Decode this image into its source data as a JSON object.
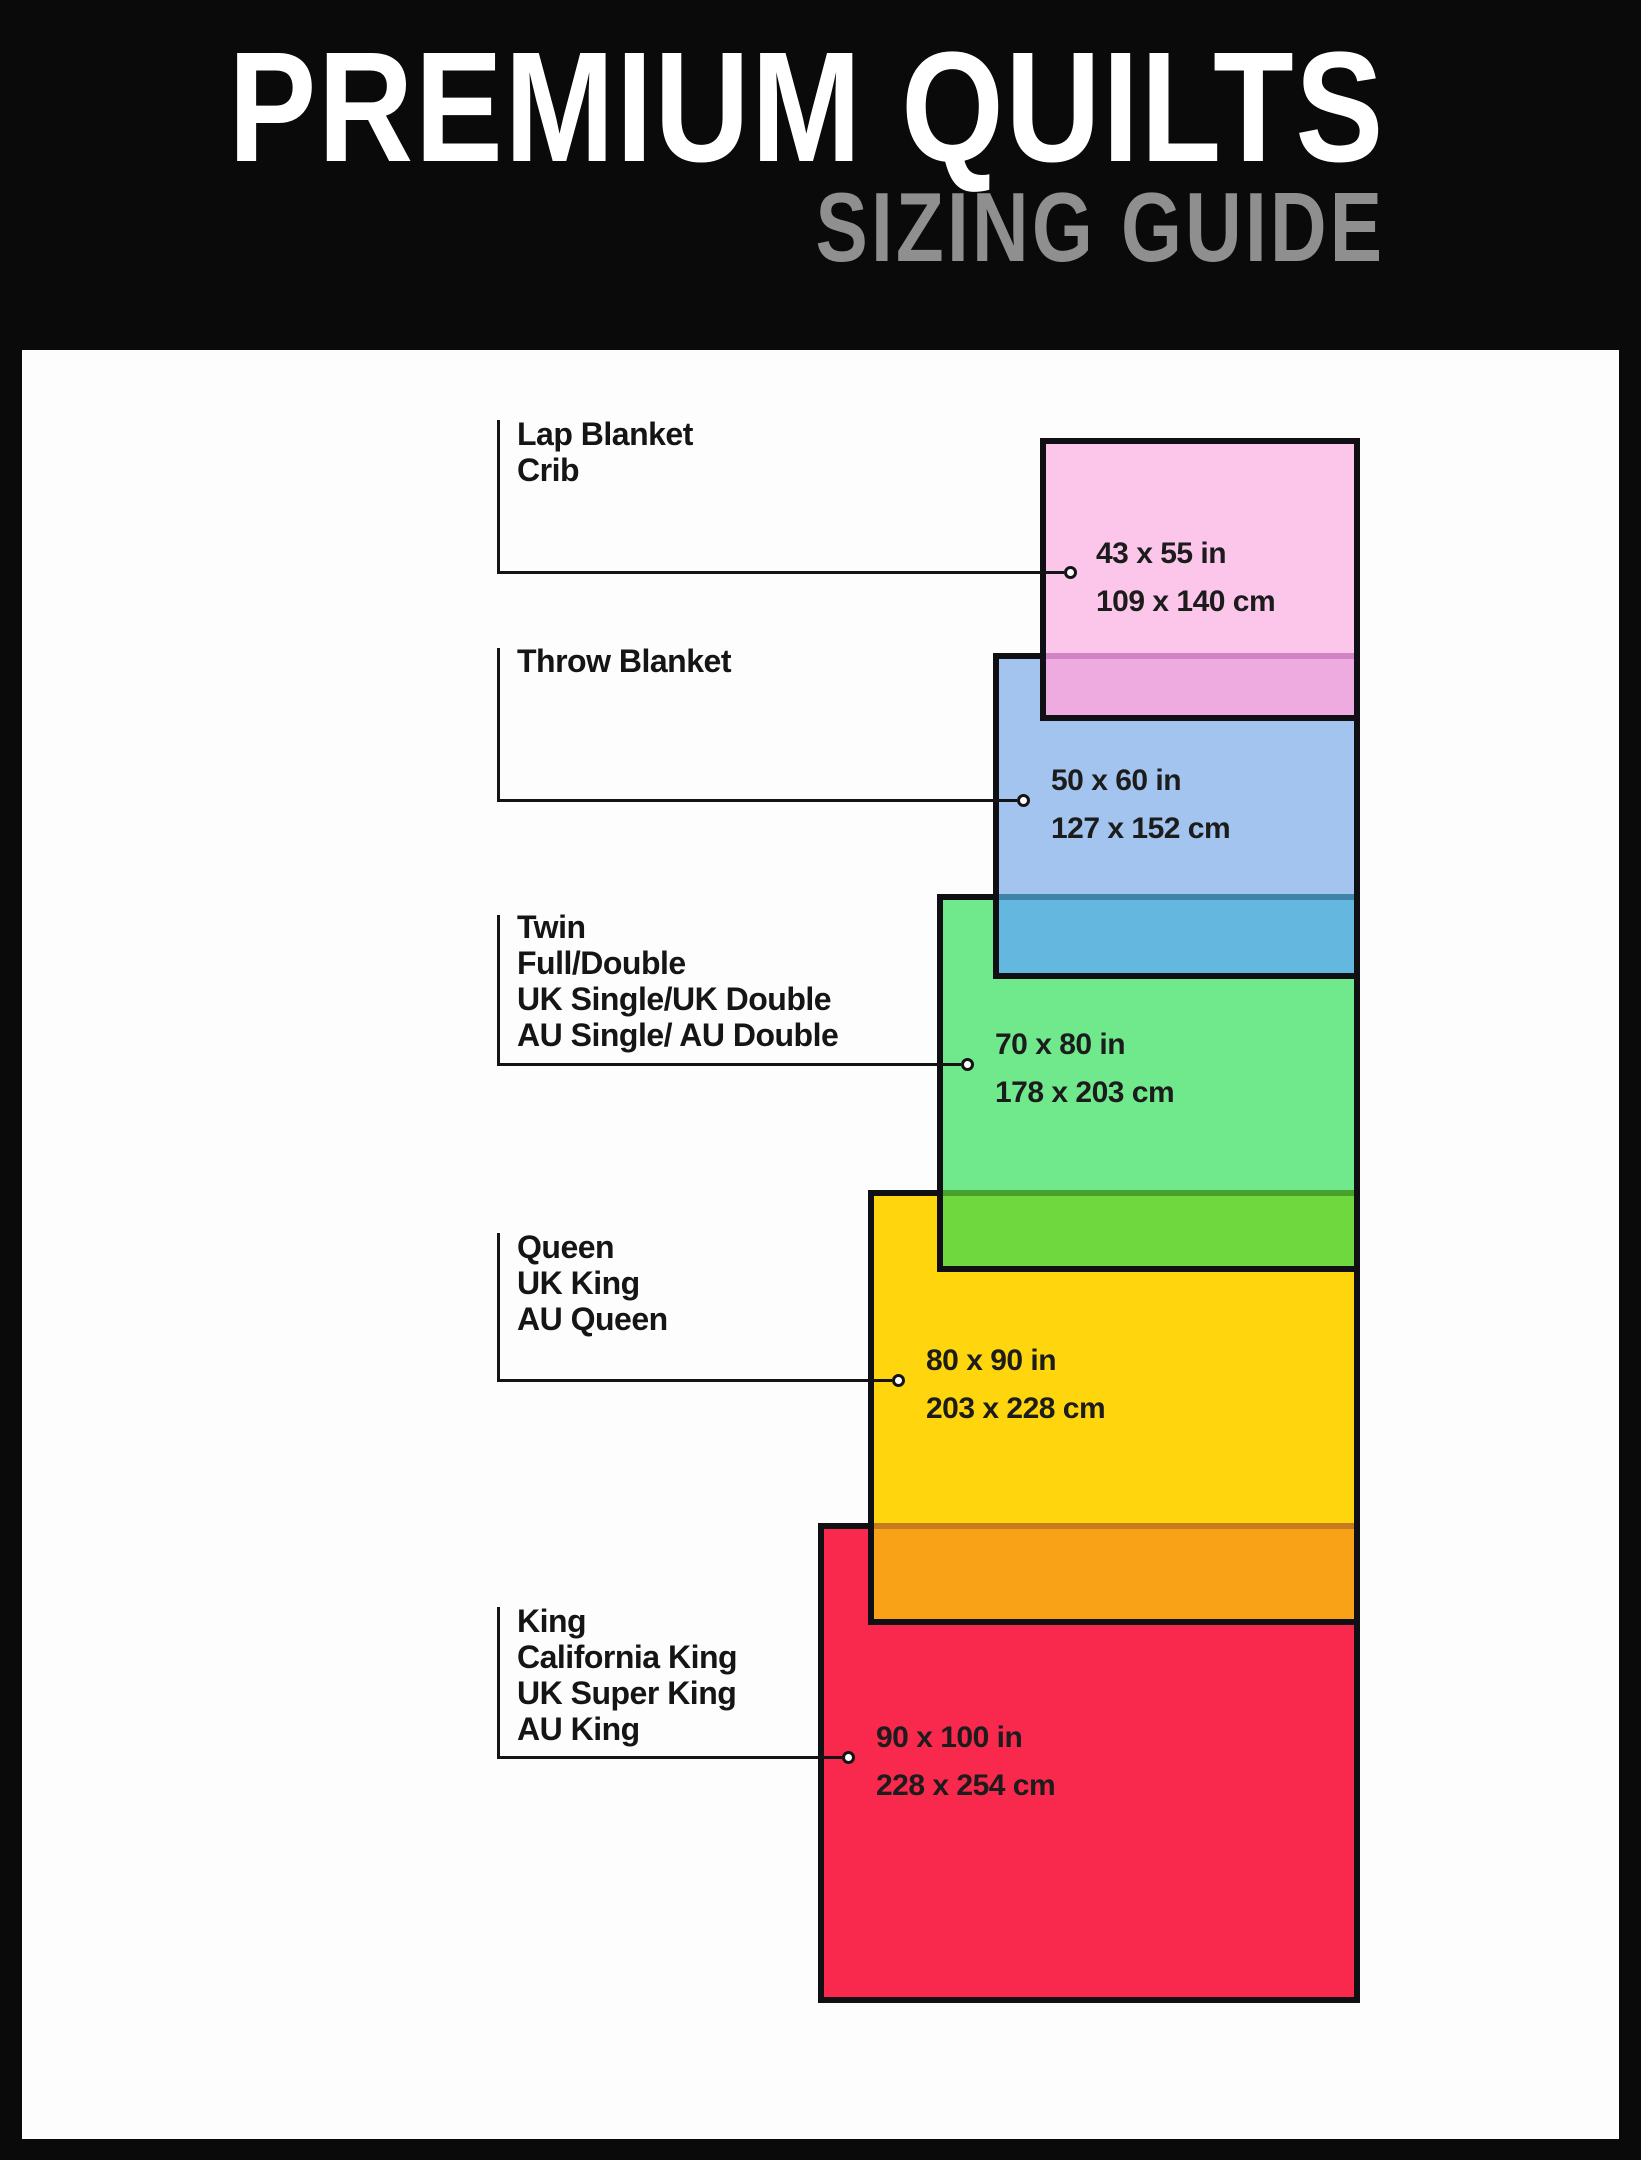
{
  "header": {
    "title": "PREMIUM QUILTS",
    "subtitle": "SIZING GUIDE"
  },
  "palette": {
    "frame": "#0a0a0a",
    "panel": "#fdfdfd",
    "connector_line": "#141414",
    "rect_border": "#101014",
    "title_text": "#ffffff",
    "subtitle_text": "#8f8f8f",
    "label_text": "#151515"
  },
  "sizes": [
    {
      "id": "lap-blanket-crib",
      "names": [
        "Lap Blanket",
        "Crib"
      ],
      "inches": "43 x 55 in",
      "cm": "109 x 140 cm",
      "fill": "#fbc6ea",
      "overlap_fill": "#eeabdf",
      "overlap_border": "#d183c4"
    },
    {
      "id": "throw-blanket",
      "names": [
        "Throw Blanket"
      ],
      "inches": "50 x 60 in",
      "cm": "127 x 152 cm",
      "fill": "#a3c4ef",
      "overlap_fill": "#64b8e0",
      "overlap_border": "#3f83a8"
    },
    {
      "id": "twin-full-double",
      "names": [
        "Twin",
        "Full/Double",
        "UK Single/UK Double",
        "AU Single/ AU Double"
      ],
      "inches": "70 x 80 in",
      "cm": "178 x 203 cm",
      "fill": "#6fe98c",
      "overlap_fill": "#6fd83f",
      "overlap_border": "#46a02c"
    },
    {
      "id": "queen-uk-king-au-queen",
      "names": [
        "Queen",
        "UK King",
        "AU Queen"
      ],
      "inches": "80 x 90 in",
      "cm": "203 x 228 cm",
      "fill": "#ffd60e",
      "overlap_fill": "#f9a218",
      "overlap_border": "#c87a20"
    },
    {
      "id": "king-california-king",
      "names": [
        "King",
        "California King",
        "UK Super King",
        "AU King"
      ],
      "inches": "90 x 100 in",
      "cm": "228 x 254 cm",
      "fill": "#f9294e",
      "overlap_fill": null,
      "overlap_border": null
    }
  ]
}
